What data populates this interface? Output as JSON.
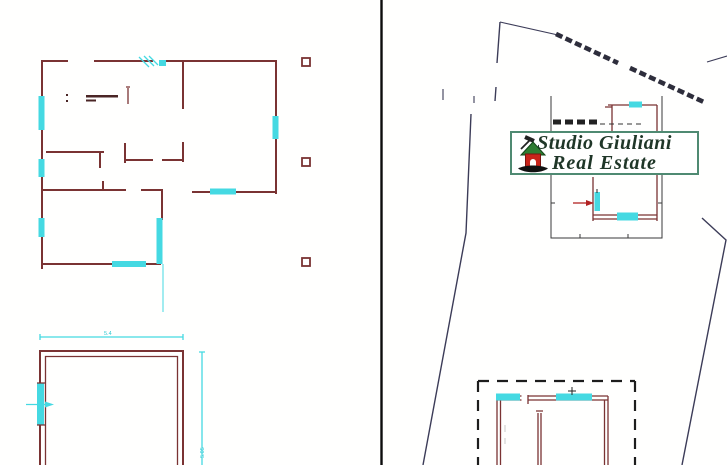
{
  "logo": {
    "line1": "Studio Giuliani",
    "line2": "Real Estate",
    "border_color": "#4f8a72",
    "text_color": "#1f3628",
    "house_body_color": "#c8241a",
    "house_roof_color": "#2e7d32",
    "hand_color": "#111111"
  },
  "left_panel": {
    "type": "apartment floor plan drawing",
    "wall_color": "#7a3333",
    "window_color": "#45d9e2",
    "column_marker_count": 3,
    "lower_room": {
      "width_dimension_label": "5.4",
      "height_dimension_label": "5.05"
    }
  },
  "right_panel": {
    "type": "site plan drawing",
    "boundary_color": "#3c3c58",
    "building_wall_color": "#7a3333",
    "window_color": "#45d9e2",
    "entrance_arrow_color": "#b22222"
  }
}
